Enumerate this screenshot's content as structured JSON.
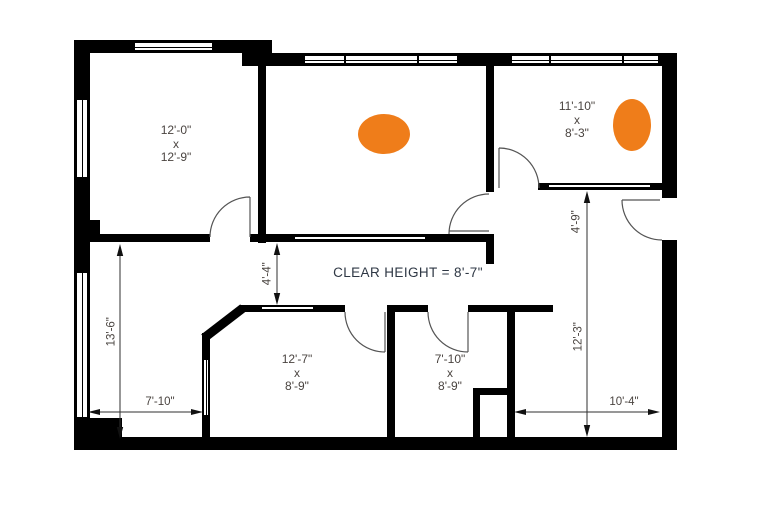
{
  "title": "Floor plan",
  "colors": {
    "wall": "#000000",
    "accent_orange": "#EF7D1A",
    "dimension_text": "#4a4440",
    "annotation_text": "#2e3744"
  },
  "rooms": [
    {
      "id": "top-left",
      "w": "12'-0\"",
      "sep": "x",
      "d": "12'-9\""
    },
    {
      "id": "top-right",
      "w": "11'-10\"",
      "sep": "x",
      "d": "8'-3\""
    },
    {
      "id": "bottom-middle",
      "w": "12'-7\"",
      "sep": "x",
      "d": "8'-9\""
    },
    {
      "id": "bottom-right",
      "w": "7'-10\"",
      "sep": "x",
      "d": "8'-9\""
    }
  ],
  "annotations": {
    "clear_height": "CLEAR HEIGHT = 8'-7\""
  },
  "dimensions": [
    {
      "id": "left-room-height",
      "label": "13'-6\""
    },
    {
      "id": "bottom-left-width",
      "label": "7'-10\""
    },
    {
      "id": "corridor-width",
      "label": "4'-4\""
    },
    {
      "id": "hall-upper-height",
      "label": "4'-9\""
    },
    {
      "id": "hall-lower-height",
      "label": "12'-3\""
    },
    {
      "id": "bottom-right-width",
      "label": "10'-4\""
    }
  ],
  "markers": [
    {
      "id": "marker-middle-room"
    },
    {
      "id": "marker-right-room"
    }
  ]
}
